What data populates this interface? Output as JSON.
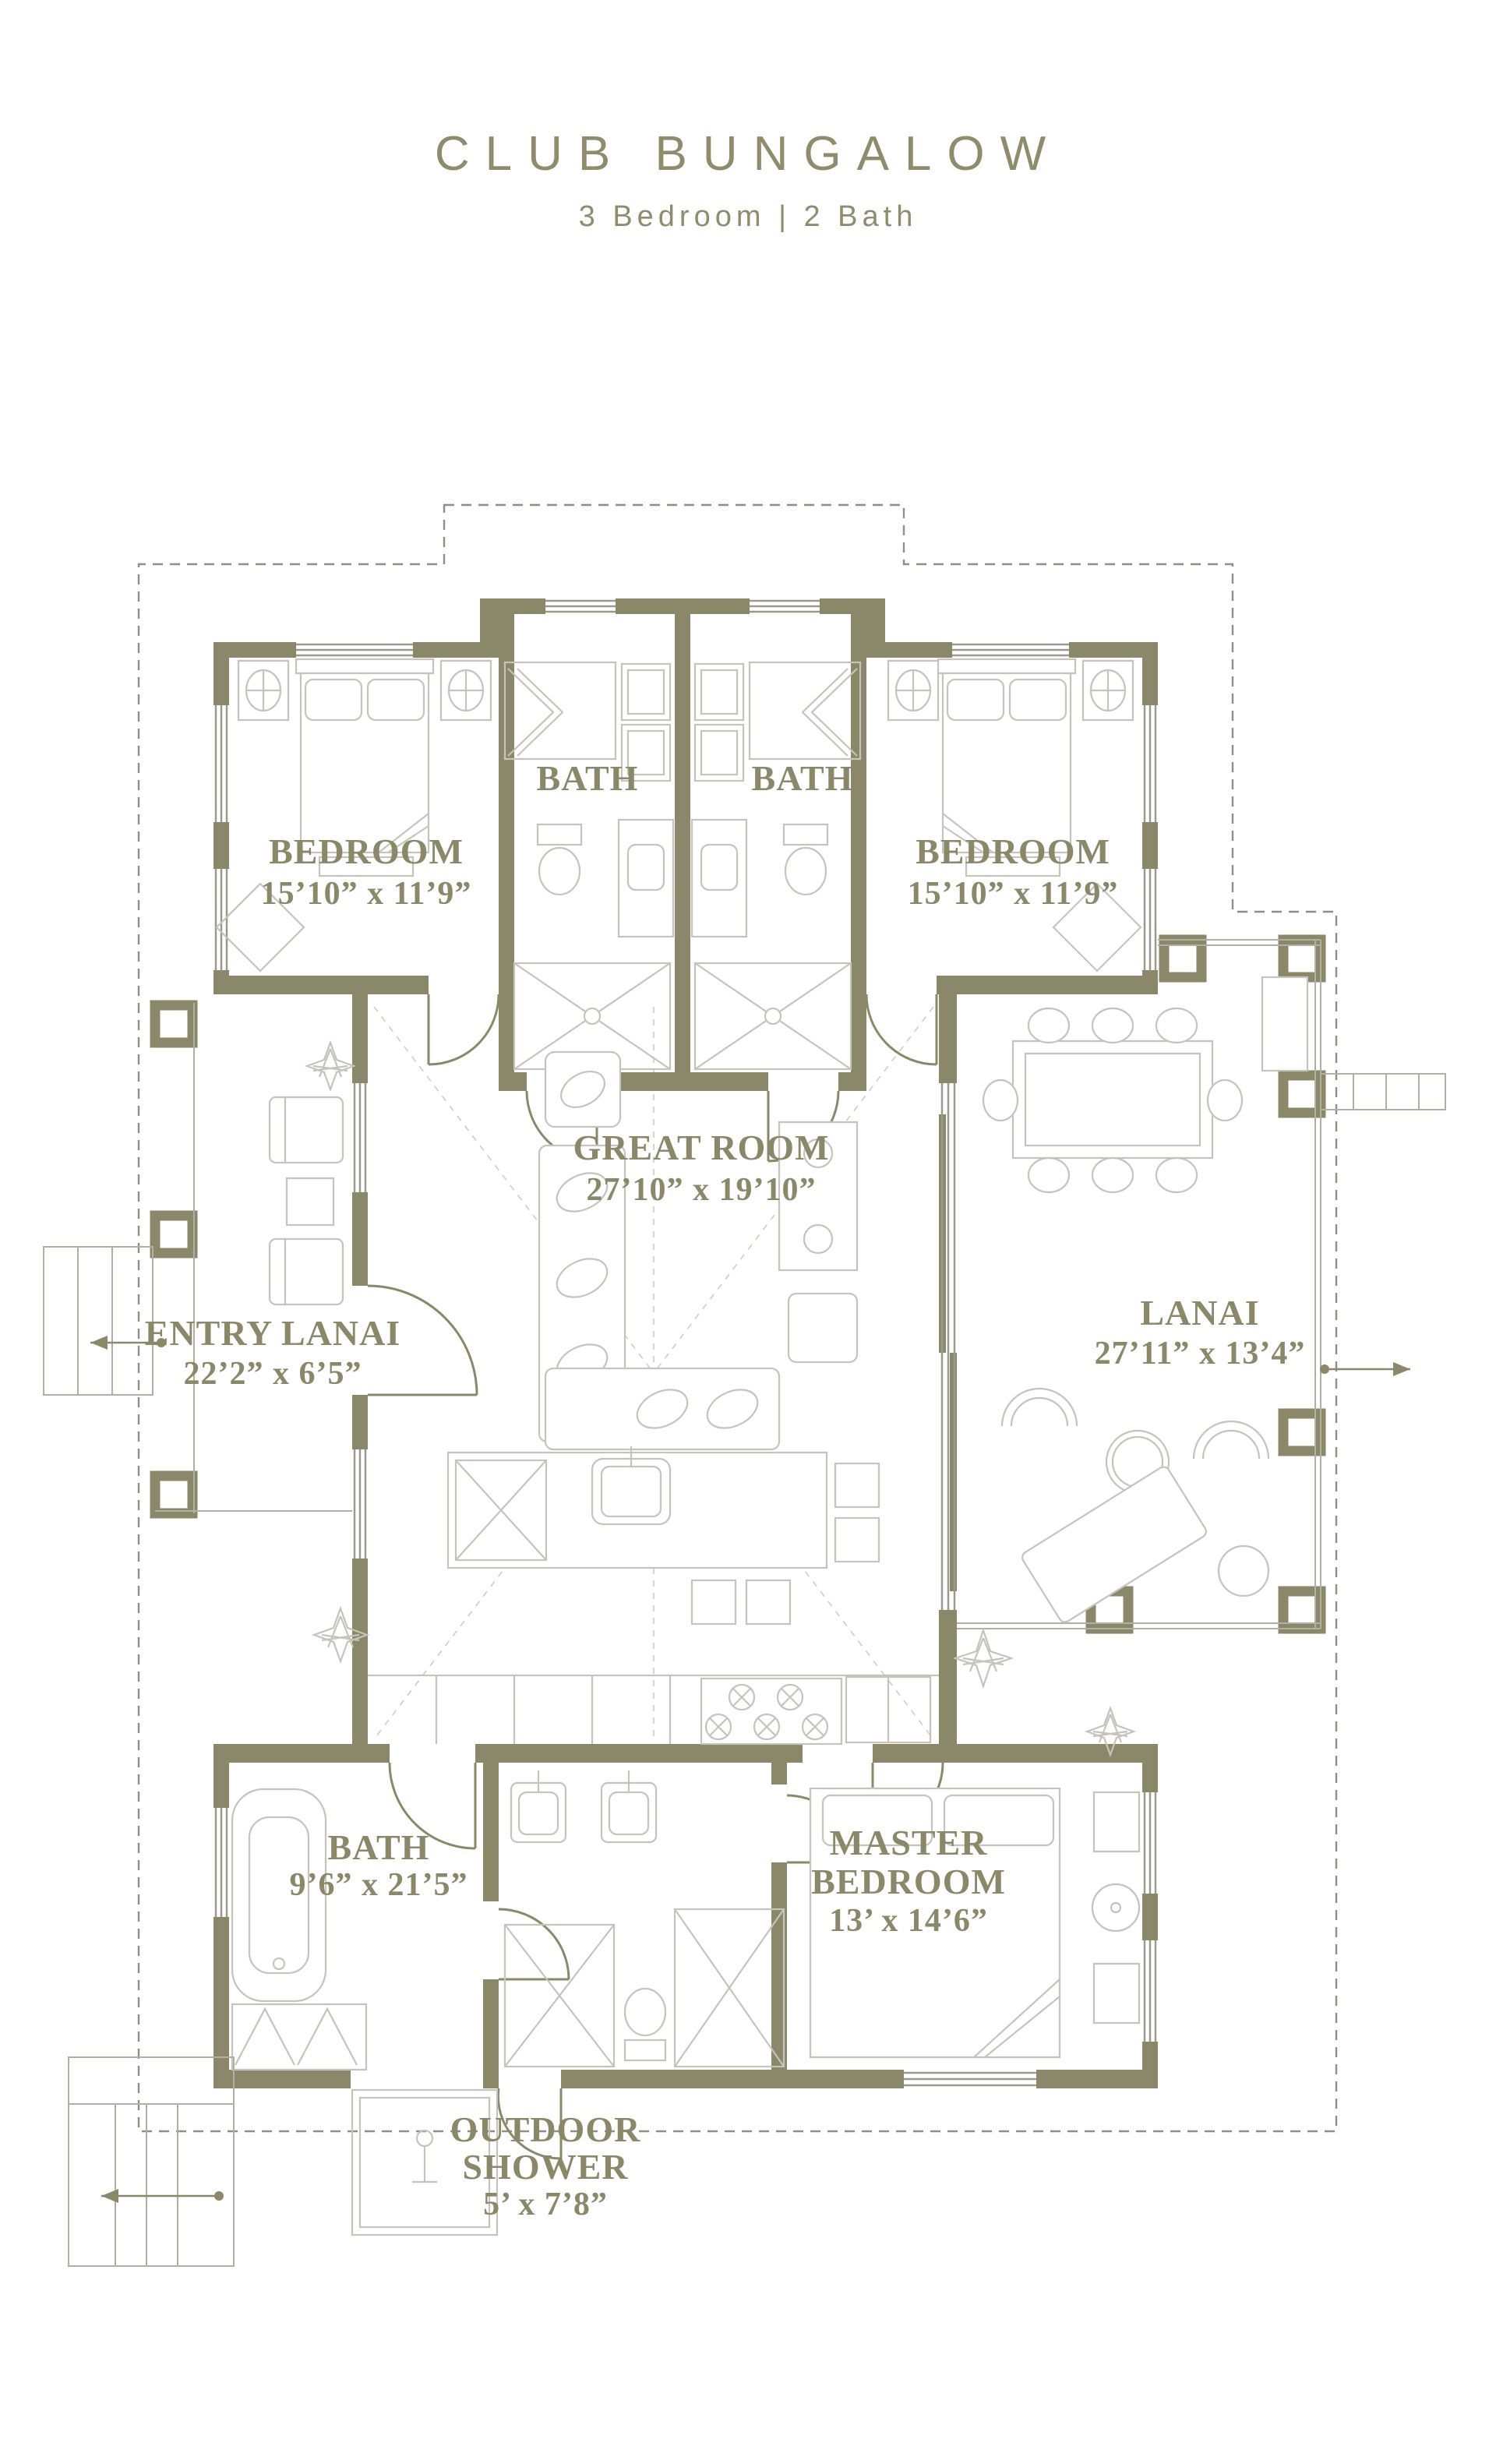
{
  "title": {
    "name": "CLUB BUNGALOW",
    "subtitle": "3 Bedroom | 2 Bath"
  },
  "colors": {
    "accent": "#8b886a",
    "furniture": "#c4c4ba",
    "roof_dash": "#8f8f85"
  },
  "rooms": {
    "bedroom_left": {
      "label": "BEDROOM",
      "dims": "15’10” x 11’9”"
    },
    "bedroom_right": {
      "label": "BEDROOM",
      "dims": "15’10” x 11’9”"
    },
    "bath_left": {
      "label": "BATH"
    },
    "bath_right": {
      "label": "BATH"
    },
    "great_room": {
      "label": "GREAT ROOM",
      "dims": "27’10” x 19’10”"
    },
    "lanai": {
      "label": "LANAI",
      "dims": "27’11” x 13’4”"
    },
    "entry_lanai": {
      "label": "ENTRY LANAI",
      "dims": "22’2” x 6’5”"
    },
    "bath_master": {
      "label": "BATH",
      "dims": "9’6” x 21’5”"
    },
    "master_bedroom": {
      "line1": "MASTER",
      "line2": "BEDROOM",
      "dims": "13’ x 14’6”"
    },
    "outdoor_shower": {
      "line1": "OUTDOOR",
      "line2": "SHOWER",
      "dims": "5’ x 7’8”"
    }
  }
}
